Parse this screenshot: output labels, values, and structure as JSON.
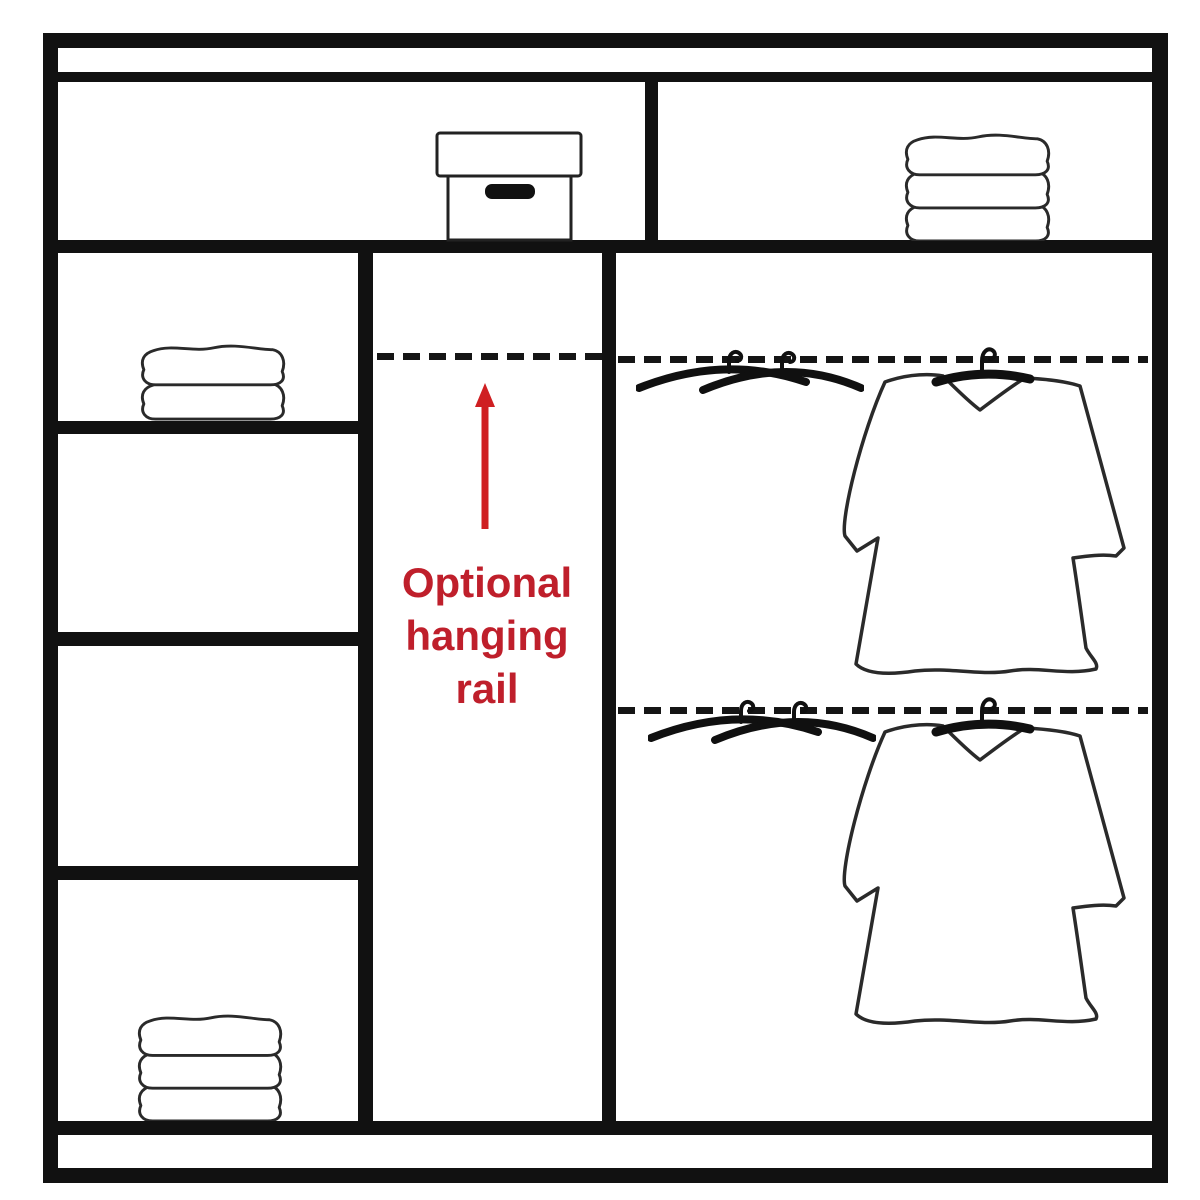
{
  "annotation": {
    "lines": [
      "Optional",
      "hanging",
      "rail"
    ],
    "full_text": "Optional hanging rail"
  },
  "colors": {
    "line_black": "#111111",
    "background_white": "#ffffff",
    "annotation_red": "#bf1f2b",
    "arrow_red": "#cf1f22"
  },
  "icons": [
    {
      "name": "storage-box-icon",
      "location": "top shelf left bay"
    },
    {
      "name": "folded-towels-icon",
      "location": "top shelf right bay",
      "folds": 3
    },
    {
      "name": "folded-towels-icon",
      "location": "left column second shelf",
      "folds": 2
    },
    {
      "name": "folded-towels-icon",
      "location": "left column bottom shelf",
      "folds": 3
    },
    {
      "name": "crossed-hangers-icon",
      "location": "right bay upper rail"
    },
    {
      "name": "hanging-shirt-icon",
      "location": "right bay upper rail"
    },
    {
      "name": "crossed-hangers-icon",
      "location": "right bay lower rail"
    },
    {
      "name": "hanging-shirt-icon",
      "location": "right bay lower rail"
    },
    {
      "name": "up-arrow-icon",
      "location": "middle bay pointing at rail line"
    }
  ],
  "structure": {
    "dashed_rail_lines": 3,
    "left_column_shelves": 4,
    "top_shelf_bays": 2
  }
}
